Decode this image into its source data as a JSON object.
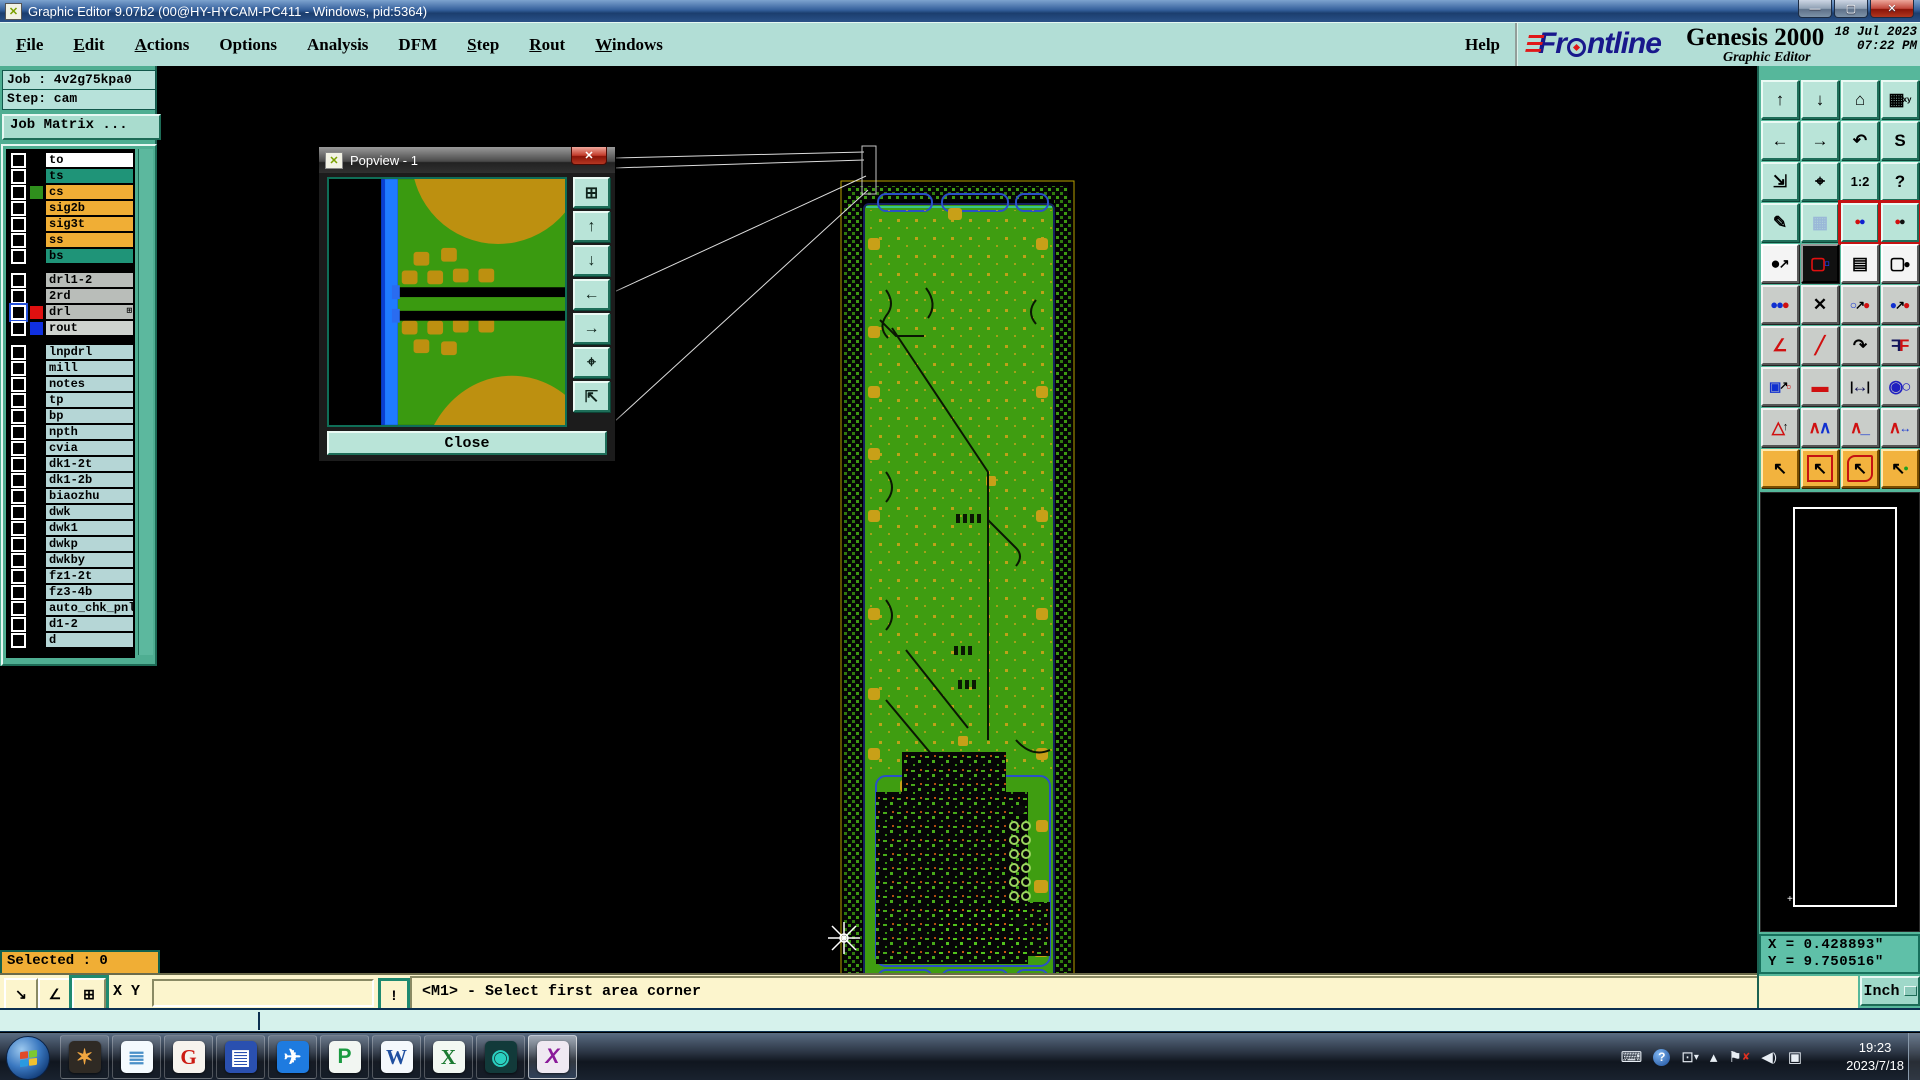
{
  "window": {
    "title": "Graphic Editor 9.07b2 (00@HY-HYCAM-PC411 - Windows, pid:5364)"
  },
  "menu": {
    "items": [
      {
        "t": "File",
        "u": 1
      },
      {
        "t": "Edit",
        "u": 1
      },
      {
        "t": "Actions",
        "u": 1
      },
      {
        "t": "Options",
        "u": 0
      },
      {
        "t": "Analysis",
        "u": 0
      },
      {
        "t": "DFM",
        "u": 0
      },
      {
        "t": "Step",
        "u": 1
      },
      {
        "t": "Rout",
        "u": 1
      },
      {
        "t": "Windows",
        "u": 1
      }
    ],
    "help": "Help"
  },
  "brand": {
    "name": "Frontline",
    "product": "Genesis 2000",
    "subtitle": "Graphic Editor",
    "date": "18 Jul 2023",
    "time": "07:22 PM"
  },
  "job": {
    "job_line": "Job : 4v2g75kpa0",
    "step_line": "Step: cam",
    "matrix_button": "Job Matrix ..."
  },
  "layers": {
    "groups": [
      {
        "rows": [
          {
            "label": "to",
            "bg": "#ffffff"
          },
          {
            "label": "ts",
            "bg": "#1f9478"
          },
          {
            "label": "cs",
            "bg": "#f0ae35",
            "swatch": "#2f8f1d"
          },
          {
            "label": "sig2b",
            "bg": "#f0ae35"
          },
          {
            "label": "sig3t",
            "bg": "#f0ae35"
          },
          {
            "label": "ss",
            "bg": "#f0ae35"
          },
          {
            "label": "bs",
            "bg": "#1f9478"
          }
        ]
      },
      {
        "rows": [
          {
            "label": "drl1-2",
            "bg": "#b9bdb9"
          },
          {
            "label": "2rd",
            "bg": "#b9bdb9"
          },
          {
            "label": "drl",
            "bg": "#b9bdb9",
            "swatch": "#e01010",
            "accent": 1,
            "marker": "⊞"
          },
          {
            "label": "rout",
            "bg": "#ced2ce",
            "swatch": "#1030e0"
          }
        ]
      },
      {
        "rows": [
          {
            "label": "lnpdrl",
            "bg": "#b5d6d6"
          },
          {
            "label": "mill",
            "bg": "#b5d6d6"
          },
          {
            "label": "notes",
            "bg": "#b5d6d6"
          },
          {
            "label": "tp",
            "bg": "#b5d6d6"
          },
          {
            "label": "bp",
            "bg": "#b5d6d6"
          },
          {
            "label": "npth",
            "bg": "#b5d6d6"
          },
          {
            "label": "cvia",
            "bg": "#b5d6d6"
          },
          {
            "label": "dk1-2t",
            "bg": "#b5d6d6"
          },
          {
            "label": "dk1-2b",
            "bg": "#b5d6d6"
          },
          {
            "label": "biaozhu",
            "bg": "#b5d6d6"
          },
          {
            "label": "dwk",
            "bg": "#b5d6d6"
          },
          {
            "label": "dwk1",
            "bg": "#b5d6d6"
          },
          {
            "label": "dwkp",
            "bg": "#b5d6d6"
          },
          {
            "label": "dwkby",
            "bg": "#b5d6d6"
          },
          {
            "label": "fz1-2t",
            "bg": "#b5d6d6"
          },
          {
            "label": "fz3-4b",
            "bg": "#b5d6d6"
          },
          {
            "label": "auto_chk_pnl",
            "bg": "#b5d6d6"
          },
          {
            "label": "d1-2",
            "bg": "#b5d6d6"
          },
          {
            "label": "d",
            "bg": "#b5d6d6"
          }
        ]
      }
    ]
  },
  "popview": {
    "title": "Popview - 1",
    "close_label": "Close",
    "icons": [
      {
        "name": "detach-view-icon",
        "g": "⊞"
      },
      {
        "name": "pan-up-icon",
        "g": "↑"
      },
      {
        "name": "pan-down-icon",
        "g": "↓"
      },
      {
        "name": "pan-left-icon",
        "g": "←"
      },
      {
        "name": "pan-right-icon",
        "g": "→"
      },
      {
        "name": "zoom-in-icon",
        "g": "⌖"
      },
      {
        "name": "zoom-out-icon",
        "g": "⇱"
      }
    ]
  },
  "toolbar": {
    "buttons": [
      {
        "name": "pan-up-button",
        "cls": "mint",
        "parts": [
          {
            "t": "↑"
          }
        ]
      },
      {
        "name": "pan-down-button",
        "cls": "mint",
        "parts": [
          {
            "t": "↓"
          }
        ]
      },
      {
        "name": "home-view-button",
        "cls": "mint",
        "parts": [
          {
            "t": "⌂"
          }
        ]
      },
      {
        "name": "window-xy-button",
        "cls": "mint",
        "parts": [
          {
            "t": "▦"
          },
          {
            "t": "xy",
            "s": 8
          }
        ]
      },
      {
        "name": "pan-left-button",
        "cls": "mint",
        "parts": [
          {
            "t": "←"
          }
        ]
      },
      {
        "name": "pan-right-button",
        "cls": "mint",
        "parts": [
          {
            "t": "→"
          }
        ]
      },
      {
        "name": "previous-view-button",
        "cls": "mint",
        "parts": [
          {
            "t": "↶"
          }
        ]
      },
      {
        "name": "step-sequence-button",
        "cls": "mint",
        "parts": [
          {
            "t": "S"
          }
        ]
      },
      {
        "name": "zoom-fit-button",
        "cls": "mint",
        "parts": [
          {
            "t": "⇲"
          }
        ]
      },
      {
        "name": "zoom-center-button",
        "cls": "mint",
        "parts": [
          {
            "t": "⌖"
          }
        ]
      },
      {
        "name": "zoom-scale-button",
        "cls": "mint",
        "parts": [
          {
            "t": "1:2",
            "s": 13
          }
        ]
      },
      {
        "name": "help-button",
        "cls": "mint",
        "parts": [
          {
            "t": "?"
          }
        ]
      },
      {
        "name": "setup-tools-button",
        "cls": "mint",
        "parts": [
          {
            "t": "✎"
          }
        ]
      },
      {
        "name": "grid-toggle-button",
        "cls": "mint",
        "parts": [
          {
            "t": "▦",
            "c": "#9ab8d8"
          }
        ]
      },
      {
        "name": "net-highlight-button",
        "cls": "mint red",
        "parts": [
          {
            "t": "●",
            "c": "#d01010",
            "s": 11
          },
          {
            "t": "●",
            "c": "#1020d0",
            "s": 11
          }
        ]
      },
      {
        "name": "net-compare-button",
        "cls": "mint red",
        "parts": [
          {
            "t": "●",
            "c": "#d01010",
            "s": 11
          },
          {
            "t": "●",
            "c": "#101010",
            "s": 11
          }
        ]
      },
      {
        "name": "select-symbol-button",
        "cls": "white",
        "parts": [
          {
            "t": "●"
          },
          {
            "t": "↗",
            "s": 13
          }
        ]
      },
      {
        "name": "shape-edit-button",
        "cls": "black",
        "parts": [
          {
            "t": "▢",
            "c": "#e01010"
          },
          {
            "t": "▫",
            "c": "#2040ff"
          }
        ]
      },
      {
        "name": "measure-ruler-button",
        "cls": "white",
        "parts": [
          {
            "t": "▤"
          }
        ]
      },
      {
        "name": "select-dashed-button",
        "cls": "white",
        "parts": [
          {
            "t": "▢"
          },
          {
            "t": "●",
            "s": 12
          }
        ]
      },
      {
        "name": "chain-select-button",
        "cls": "silver",
        "parts": [
          {
            "t": "●",
            "c": "#1030d0",
            "s": 13
          },
          {
            "t": "●",
            "c": "#1030d0",
            "s": 13
          },
          {
            "t": "●",
            "c": "#d01010",
            "s": 13
          }
        ]
      },
      {
        "name": "delete-object-button",
        "cls": "silver",
        "parts": [
          {
            "t": "✕"
          }
        ]
      },
      {
        "name": "copy-object-button",
        "cls": "silver",
        "parts": [
          {
            "t": "○",
            "c": "#1030d0",
            "s": 12
          },
          {
            "t": "↗",
            "s": 12
          },
          {
            "t": "●",
            "c": "#d01010",
            "s": 12
          }
        ]
      },
      {
        "name": "move-object-button",
        "cls": "silver",
        "parts": [
          {
            "t": "●",
            "c": "#1030d0",
            "s": 12
          },
          {
            "t": "↗",
            "s": 12
          },
          {
            "t": "●",
            "c": "#d01010",
            "s": 12
          }
        ]
      },
      {
        "name": "measure-angle-button",
        "cls": "silver",
        "parts": [
          {
            "t": "∠",
            "c": "#d01010"
          }
        ]
      },
      {
        "name": "measure-slant-button",
        "cls": "silver",
        "parts": [
          {
            "t": "╱",
            "c": "#d01010"
          }
        ]
      },
      {
        "name": "rotate-object-button",
        "cls": "silver",
        "parts": [
          {
            "t": "↷"
          }
        ]
      },
      {
        "name": "mirror-object-button",
        "cls": "silver",
        "parts": [
          {
            "t": "F",
            "c": "#14145a",
            "f": 1
          },
          {
            "t": "F",
            "c": "#d01010"
          }
        ]
      },
      {
        "name": "copy-to-layer-button",
        "cls": "silver",
        "parts": [
          {
            "t": "▣",
            "c": "#1030d0",
            "s": 13
          },
          {
            "t": "↗",
            "s": 11
          },
          {
            "t": "▫",
            "c": "#d01010",
            "s": 13
          }
        ]
      },
      {
        "name": "stretch-line-button",
        "cls": "silver",
        "parts": [
          {
            "t": "▬",
            "c": "#d01010"
          }
        ]
      },
      {
        "name": "measure-distance-button",
        "cls": "silver",
        "parts": [
          {
            "t": "|",
            "s": 13
          },
          {
            "t": "↔",
            "c": "#14145a"
          },
          {
            "t": "|",
            "s": 13
          }
        ]
      },
      {
        "name": "surface-edit-button",
        "cls": "silver",
        "parts": [
          {
            "t": "◉",
            "c": "#2020c0"
          },
          {
            "t": "○",
            "c": "#2020c0"
          }
        ]
      },
      {
        "name": "add-polygon-arrow-button",
        "cls": "silver",
        "parts": [
          {
            "t": "△",
            "c": "#d01010"
          },
          {
            "t": "↑",
            "s": 11
          }
        ]
      },
      {
        "name": "add-polygon-double-button",
        "cls": "silver",
        "parts": [
          {
            "t": "∧",
            "c": "#d01010"
          },
          {
            "t": "∧",
            "c": "#1030d0"
          }
        ]
      },
      {
        "name": "add-polygon-base-button",
        "cls": "silver",
        "parts": [
          {
            "t": "∧",
            "c": "#d01010"
          },
          {
            "t": "_",
            "c": "#1030d0"
          }
        ]
      },
      {
        "name": "add-polygon-wide-button",
        "cls": "silver",
        "parts": [
          {
            "t": "∧",
            "c": "#d01010"
          },
          {
            "t": "↔",
            "c": "#1030d0",
            "s": 12
          }
        ]
      },
      {
        "name": "select-single-button",
        "cls": "orange",
        "parts": [
          {
            "t": "↖",
            "c": "#000"
          }
        ]
      },
      {
        "name": "select-frame-button",
        "cls": "orange redin",
        "parts": [
          {
            "t": "↖",
            "c": "#000"
          }
        ]
      },
      {
        "name": "select-polygon-button",
        "cls": "orange redin poly",
        "parts": [
          {
            "t": "↖",
            "c": "#000"
          }
        ]
      },
      {
        "name": "select-net-button",
        "cls": "orange",
        "parts": [
          {
            "t": "↖",
            "c": "#000"
          },
          {
            "t": "●",
            "c": "#20a020",
            "s": 9
          }
        ]
      }
    ]
  },
  "coords": {
    "x": "X = 0.428893\"",
    "y": "Y = 9.750516\""
  },
  "units": {
    "label": "Inch"
  },
  "status": {
    "selected": "Selected : 0",
    "xy_label": "X Y :",
    "input_value": "",
    "prompt": "<M1> - Select first area corner"
  },
  "command_icons": [
    {
      "name": "zoom-area-mode-button",
      "g": "↘",
      "active": 0
    },
    {
      "name": "angle-mode-button",
      "g": "∠",
      "active": 0
    },
    {
      "name": "tile-windows-button",
      "g": "⊞",
      "active": 1
    }
  ],
  "taskbar": {
    "time": "19:23",
    "date": "2023/7/18",
    "apps": [
      {
        "name": "taskbar-app-shell",
        "tile": "#2f2a24",
        "g": "✶",
        "c": "#f0a640"
      },
      {
        "name": "taskbar-app-notepad",
        "tile": "#f4fafe",
        "g": "≣",
        "c": "#4a90c8"
      },
      {
        "name": "taskbar-app-genesis",
        "tile": "#f6f3ee",
        "g": "G",
        "c": "#cc1a12",
        "st": "serif"
      },
      {
        "name": "taskbar-app-cam350",
        "tile": "#2a50b0",
        "g": "▤",
        "c": "#ffffff"
      },
      {
        "name": "taskbar-app-dingtalk",
        "tile": "#1e7be0",
        "g": "✈",
        "c": "#ffffff"
      },
      {
        "name": "taskbar-app-protel",
        "tile": "#f2f6f2",
        "g": "P",
        "c": "#1a9a40"
      },
      {
        "name": "taskbar-app-word",
        "tile": "#f4f8fc",
        "g": "W",
        "c": "#1f4fa0",
        "st": "serif"
      },
      {
        "name": "taskbar-app-excel",
        "tile": "#f2f8f2",
        "g": "X",
        "c": "#1a7a30",
        "st": "serif"
      },
      {
        "name": "taskbar-app-media",
        "tile": "#123a3a",
        "g": "◉",
        "c": "#2ad0c0"
      },
      {
        "name": "taskbar-app-exceed",
        "tile": "#efe9f2",
        "g": "X",
        "c": "#8a1a9a",
        "st": "italic",
        "active": 1
      }
    ],
    "tray": [
      {
        "name": "keyboard-tray-icon",
        "parts": [
          {
            "t": "⌨"
          }
        ]
      },
      {
        "name": "help-tray-icon",
        "help": 1,
        "parts": [
          {
            "t": "?"
          }
        ]
      },
      {
        "name": "window-tray-icon",
        "parts": [
          {
            "t": "⊡"
          },
          {
            "t": "▾",
            "s": 10
          }
        ]
      },
      {
        "name": "show-hidden-icons",
        "parts": [
          {
            "t": "▴"
          }
        ]
      },
      {
        "name": "action-center-flag-icon",
        "parts": [
          {
            "t": "⚑"
          },
          {
            "t": "✘",
            "c": "#e03020",
            "s": 10
          }
        ]
      },
      {
        "name": "volume-tray-icon",
        "parts": [
          {
            "t": "◀"
          },
          {
            "t": ")",
            "s": 12
          }
        ]
      },
      {
        "name": "network-tray-icon",
        "parts": [
          {
            "t": "▣"
          }
        ]
      }
    ]
  }
}
